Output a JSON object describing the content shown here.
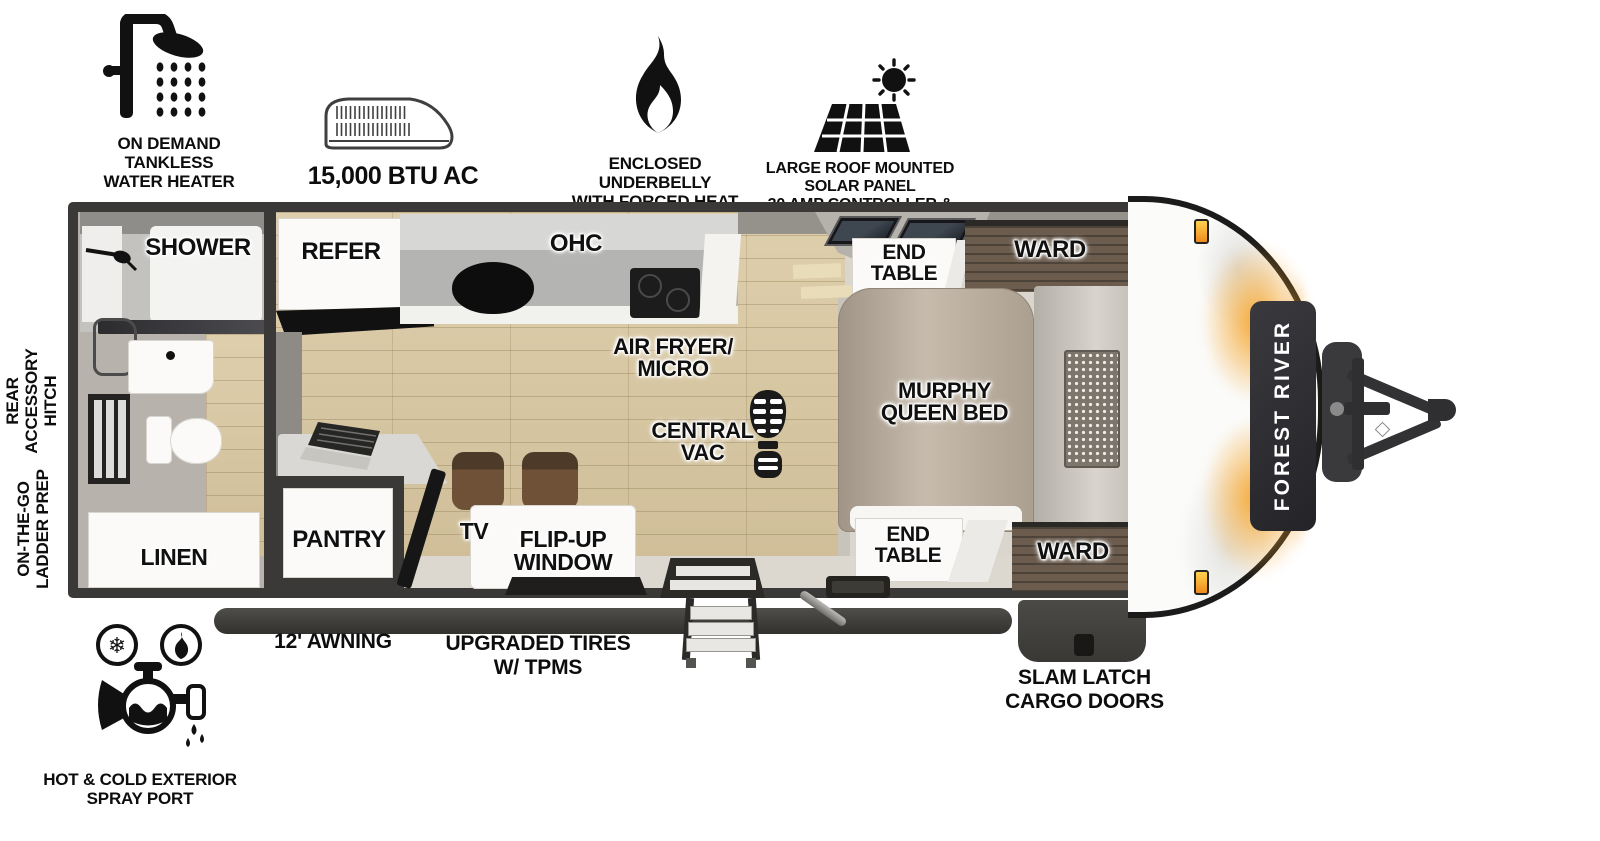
{
  "brand": "FOREST RIVER",
  "top_features": [
    {
      "name": "on-demand-tankless-water-heater",
      "icon": "shower-head-icon",
      "lines": [
        "ON DEMAND",
        "TANKLESS",
        "WATER HEATER"
      ]
    },
    {
      "name": "air-conditioner",
      "icon": "ac-unit-icon",
      "lines": [
        "15,000 BTU AC"
      ]
    },
    {
      "name": "enclosed-underbelly",
      "icon": "flame-icon",
      "lines": [
        "ENCLOSED UNDERBELLY",
        "WITH FORCED HEAT"
      ]
    },
    {
      "name": "solar-panel-prep",
      "icon": "solar-panel-icon",
      "lines": [
        "LARGE ROOF MOUNTED SOLAR PANEL",
        "30 AMP CONTROLLER & INVERTER PREP"
      ]
    }
  ],
  "left_features": {
    "rear_hitch": [
      "REAR",
      "ACCESSORY",
      "HITCH"
    ],
    "ladder": [
      "ON-THE-GO",
      "LADDER PREP"
    ]
  },
  "bottom_features": {
    "awning": "12' AWNING",
    "tires": [
      "UPGRADED TIRES",
      "W/ TPMS"
    ],
    "cargo": [
      "SLAM LATCH",
      "CARGO DOORS"
    ],
    "spray": [
      "HOT & COLD EXTERIOR",
      "SPRAY PORT"
    ]
  },
  "rooms": {
    "shower": "SHOWER",
    "linen": "LINEN",
    "refer": "REFER",
    "ohc": "OHC",
    "air_fryer": [
      "AIR FRYER/",
      "MICRO"
    ],
    "central_vac": [
      "CENTRAL",
      "VAC"
    ],
    "pantry": "PANTRY",
    "tv": "TV",
    "flip_up_window": [
      "FLIP-UP",
      "WINDOW"
    ],
    "end_table_top": [
      "END",
      "TABLE"
    ],
    "end_table_bottom": [
      "END",
      "TABLE"
    ],
    "ward_top": "WARD",
    "ward_bottom": "WARD",
    "murphy_bed": [
      "MURPHY",
      "QUEEN BED"
    ]
  },
  "colors": {
    "wall": "#3b3937",
    "floor_wood": "#d9c79f",
    "carpet": "#dad6ce",
    "cabinet_wood": "#6b5c4e",
    "accent_orange": "#f2a23b",
    "label_text": "#101010"
  }
}
